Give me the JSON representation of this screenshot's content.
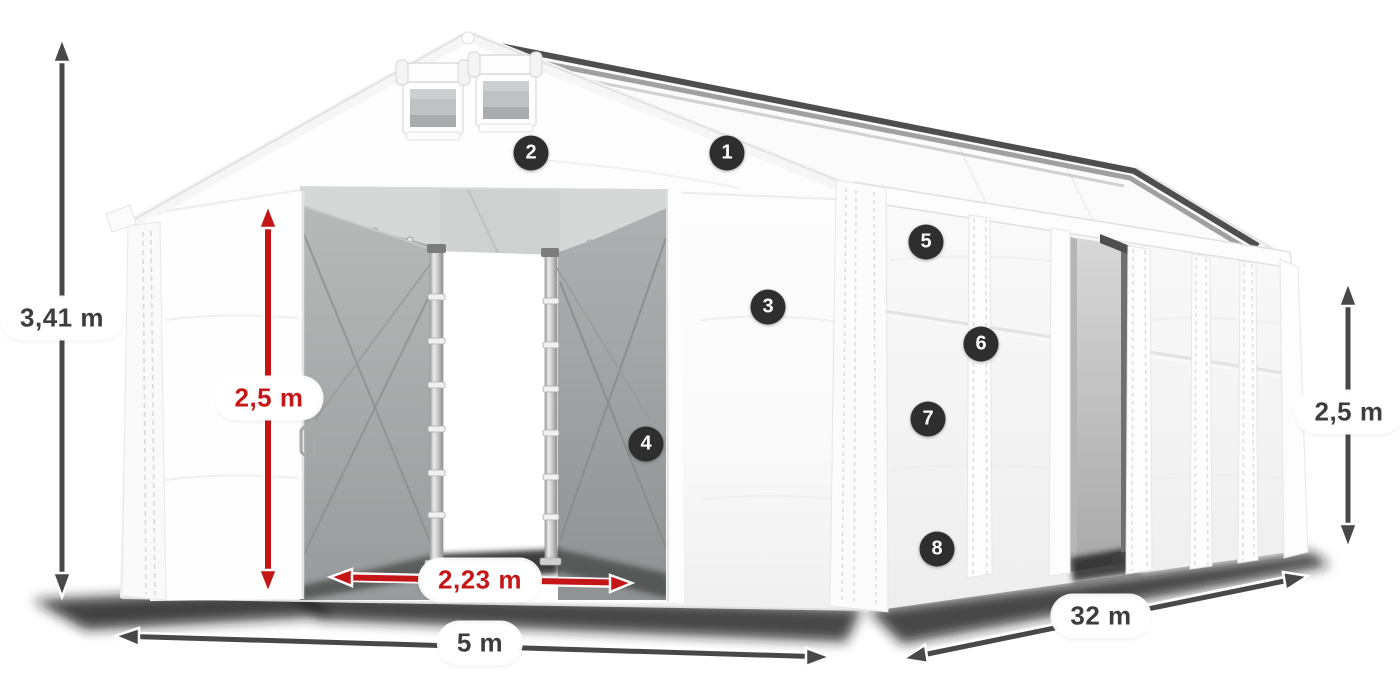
{
  "dimension_labels": {
    "total_height": "3,41 m",
    "entrance_height": "2,5 m",
    "entrance_width": "2,23 m",
    "front_width": "5 m",
    "side_length": "32 m",
    "side_wall_height": "2,5 m"
  },
  "feature_markers": [
    {
      "label": "1"
    },
    {
      "label": "2"
    },
    {
      "label": "3"
    },
    {
      "label": "4"
    },
    {
      "label": "5"
    },
    {
      "label": "6"
    },
    {
      "label": "7"
    },
    {
      "label": "8"
    }
  ],
  "colors": {
    "background": "#ffffff",
    "arrow_dark": "#484848",
    "arrow_red": "#c41616",
    "marker_background": "#2e2e2e",
    "marker_text": "#ffffff",
    "label_text_dark": "#3d3d3d",
    "label_text_red": "#c51717",
    "tent_white": "#ffffff",
    "interior_gray": "#a5a7a7"
  }
}
